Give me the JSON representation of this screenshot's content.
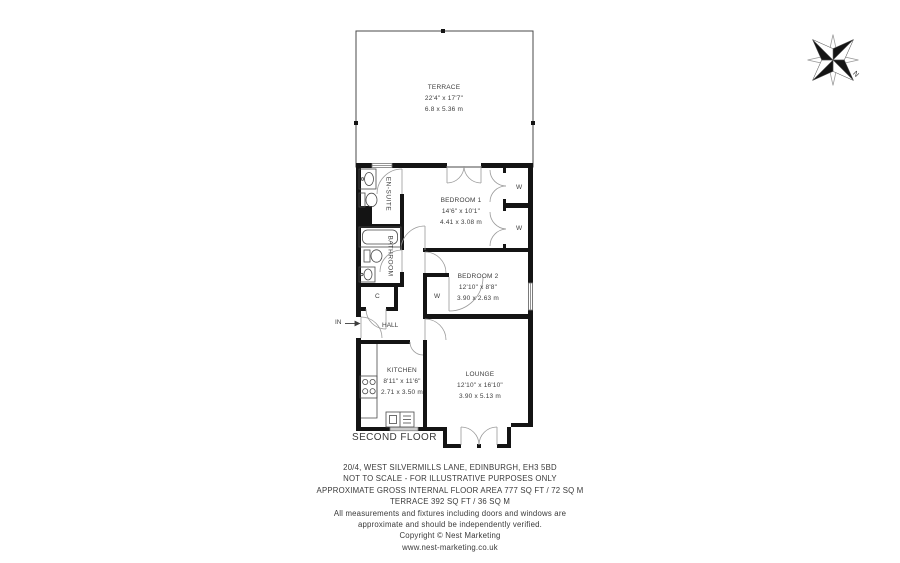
{
  "plan": {
    "floor_label": "SECOND FLOOR",
    "entry_label": "IN",
    "compass": {
      "north_label": "N"
    },
    "wardrobes": [
      "W",
      "W",
      "W"
    ],
    "rooms": {
      "terrace": {
        "name": "TERRACE",
        "imperial": "22'4\" x 17'7\"",
        "metric": "6.8 x 5.36 m"
      },
      "bedroom1": {
        "name": "BEDROOM 1",
        "imperial": "14'6\" x 10'1\"",
        "metric": "4.41 x 3.08 m"
      },
      "bedroom2": {
        "name": "BEDROOM 2",
        "imperial": "12'10\" x 8'8\"",
        "metric": "3.90 x 2.63 m"
      },
      "kitchen": {
        "name": "KITCHEN",
        "imperial": "8'11\" x 11'6\"",
        "metric": "2.71 x 3.50 m"
      },
      "lounge": {
        "name": "LOUNGE",
        "imperial": "12'10\" x 16'10\"",
        "metric": "3.90 x 5.13 m"
      },
      "ensuite": {
        "name": "EN-SUITE"
      },
      "bathroom": {
        "name": "BATHROOM"
      },
      "hall": {
        "name": "HALL"
      },
      "cupboard": {
        "name": "C"
      }
    }
  },
  "footer": {
    "address": "20/4, WEST SILVERMILLS LANE, EDINBURGH, EH3 5BD",
    "scale_note": "NOT TO SCALE - FOR ILLUSTRATIVE PURPOSES ONLY",
    "area_note": "APPROXIMATE GROSS INTERNAL FLOOR AREA 777 SQ FT / 72 SQ M",
    "terrace_area": "TERRACE 392 SQ FT / 36 SQ M",
    "disclaimer_line1": "All measurements and fixtures including doors and windows are",
    "disclaimer_line2": "approximate and should be independently verified.",
    "copyright": "Copyright © Nest Marketing",
    "website": "www.nest-marketing.co.uk"
  },
  "colors": {
    "wall": "#141414",
    "door_arc": "#9a9a9a",
    "fixture": "#4a4a4a",
    "terrace_line": "#4a4a4a"
  }
}
